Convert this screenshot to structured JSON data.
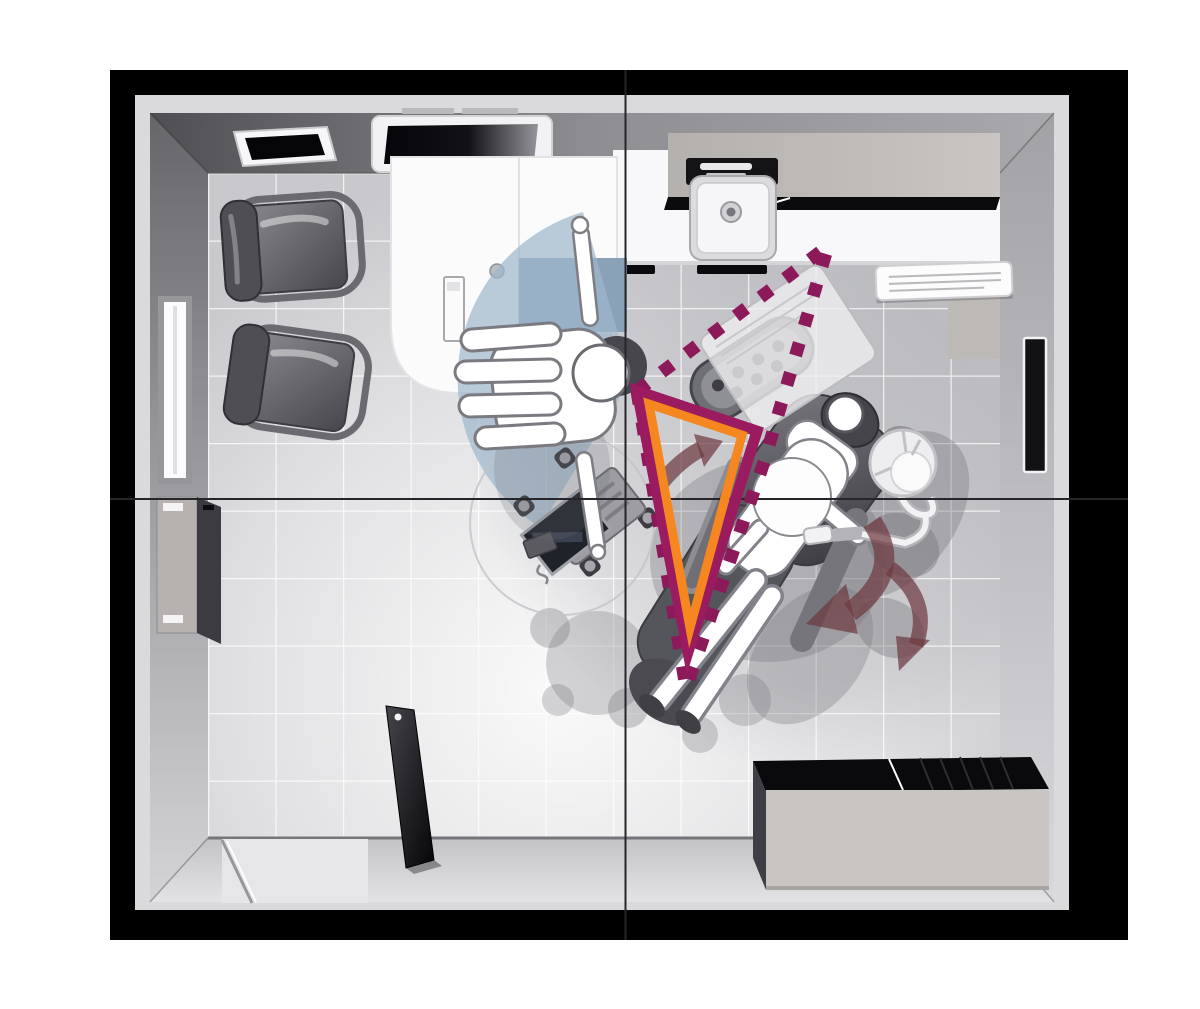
{
  "scene": {
    "kind": "dental-treatment-room-floor-plan-top-view",
    "colors": {
      "frame_black": "#000000",
      "outer_strip": "#dadadc",
      "wall_dark": "#58585c",
      "wall_light": "#d6d6d8",
      "floor_tile": "#c9c9cd",
      "grout_white": "#ffffff",
      "counter_white": "#f8f8fa",
      "cabinet_gray": "#b6b2af",
      "chair_gray": "#55555c",
      "figure_white": "#ffffff",
      "reach_zone_blue": "#9fb7cc",
      "path_magenta": "#8c1a5a",
      "triangle_magenta": "#9b1b61",
      "triangle_orange": "#f6861f",
      "rotation_arrow_maroon": "#6d3a41"
    },
    "annotations": {
      "reach_zone": {
        "d": "M 631,379 L 583,212 A 174 174 0 0 0 540,527 Z",
        "center_x": 631,
        "center_y": 379,
        "radius": 174
      },
      "movement_path": {
        "d": "M 637,391 L 828,246 L 764,462 L 686,688 Z",
        "dash": "13 18",
        "stroke_width": 13
      },
      "work_triangle": {
        "outer_points": "637,391 757,431 688,652",
        "inner_points": "649,404 742,435 690,628"
      },
      "crosshairs": {
        "vertical_d": "M 625.5 70 V 940",
        "horizontal_d": "M 110 499 H 1128"
      },
      "rotation_arrows": [
        {
          "shaft_d": "M 662,482 Q 680,460 701,449",
          "head_points": "694,434 723,441 704,467"
        },
        {
          "shaft_d": "M 890,568 Q 932,600 916,645",
          "head_points": "930,640 899,671 896,636"
        },
        {
          "shaft_d": "M 872,522 Q 905,572 850,612",
          "head_points": "858,634 806,624 846,584"
        }
      ]
    }
  }
}
